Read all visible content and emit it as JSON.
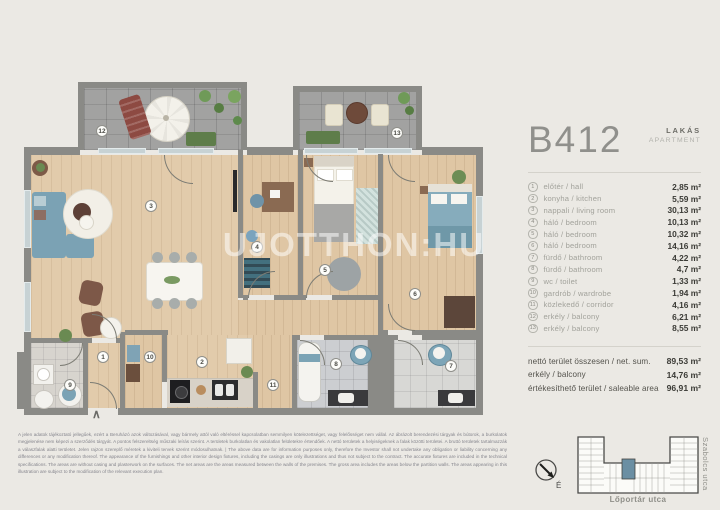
{
  "panel": {
    "unit_id": "B412",
    "type_hu": "LAKÁS",
    "type_en": "APARTMENT",
    "rooms": [
      {
        "num": "1",
        "label": "előtér  /  hall",
        "area": "2,85 m²"
      },
      {
        "num": "2",
        "label": "konyha  /  kitchen",
        "area": "5,59 m²"
      },
      {
        "num": "3",
        "label": "nappali  /  living room",
        "area": "30,13 m²"
      },
      {
        "num": "4",
        "label": "háló  /  bedroom",
        "area": "10,13 m²"
      },
      {
        "num": "5",
        "label": "háló  /  bedroom",
        "area": "10,32 m²"
      },
      {
        "num": "6",
        "label": "háló  /  bedroom",
        "area": "14,16 m²"
      },
      {
        "num": "7",
        "label": "fürdő  /  bathroom",
        "area": "4,22 m²"
      },
      {
        "num": "8",
        "label": "fürdő  /  bathroom",
        "area": "4,7 m²"
      },
      {
        "num": "9",
        "label": "wc  /  toilet",
        "area": "1,33 m²"
      },
      {
        "num": "10",
        "label": "gardrób  /  wardrobe",
        "area": "1,94 m²"
      },
      {
        "num": "11",
        "label": "közlekedő  /  corridor",
        "area": "4,16 m²"
      },
      {
        "num": "12",
        "label": "erkély  /  balcony",
        "area": "6,21 m²"
      },
      {
        "num": "13",
        "label": "erkély  /  balcony",
        "area": "8,55 m²"
      }
    ],
    "totals": [
      {
        "label": "nettó terület összesen / net. sum.",
        "area": "89,53 m²"
      },
      {
        "label": "erkély  /  balcony",
        "area": "14,76 m²"
      },
      {
        "label": "értékesíthető terület  /  saleable area",
        "area": "96,91 m²"
      }
    ]
  },
  "floorplan": {
    "watermark": "UJOTTHON:HU",
    "entry_symbol": "∧",
    "markers": [
      {
        "num": "1",
        "x": 103,
        "y": 357
      },
      {
        "num": "2",
        "x": 202,
        "y": 362
      },
      {
        "num": "3",
        "x": 151,
        "y": 206
      },
      {
        "num": "4",
        "x": 257,
        "y": 247
      },
      {
        "num": "5",
        "x": 325,
        "y": 270
      },
      {
        "num": "6",
        "x": 415,
        "y": 294
      },
      {
        "num": "7",
        "x": 451,
        "y": 366
      },
      {
        "num": "8",
        "x": 336,
        "y": 364
      },
      {
        "num": "9",
        "x": 70,
        "y": 385
      },
      {
        "num": "10",
        "x": 150,
        "y": 357
      },
      {
        "num": "11",
        "x": 273,
        "y": 385
      },
      {
        "num": "12",
        "x": 102,
        "y": 131
      },
      {
        "num": "13",
        "x": 397,
        "y": 133
      }
    ]
  },
  "disclaimer": "A jelen adatok tájékoztató jellegűek, ezért a Beruházó azok változásával, vagy bármely attól való eltéréssel kapcsolatban semmilyen kötelezettséget, vagy felelősséget nem vállal. Az ábrázolt berendezési tárgyak és bútorok, a burkolatok megjelenése nem képezi a szerződés tárgyát. A pontos felszereltség műszaki leírás szerint. A területek burkolatlan és vakolatlan felületekre értendőek. A nettó területek a helyiségeknek a falak közötti területei. A bruttó területek tartalmazzák a válaszfalak alatti területet. Jelen rajzon szereplő méretek a kiviteli tervek szerint módosulhatnak.  |  The above data are for information purposes only, therefore the Investor shall not undertake any obligation or liability concerning any differences or any modification thereof. The appearance of the furnishings and other interior design fixtures, including the casings are only illustrations and thus not subject to the contract. The accurate fixtures are included in the technical specifications. The areas are without casing and plasterwork on the surfaces. The net areas are the areas measured between the walls of the premises. The gross area includes the areas below the partition walls. The areas appearing in this illustration are subject to the modification of the relevant execution plan.",
  "siteplan": {
    "street_right": "Szabolcs utca",
    "street_bottom": "Lőportár utca",
    "compass_label": "É",
    "highlight_color": "#6b8fa3"
  }
}
